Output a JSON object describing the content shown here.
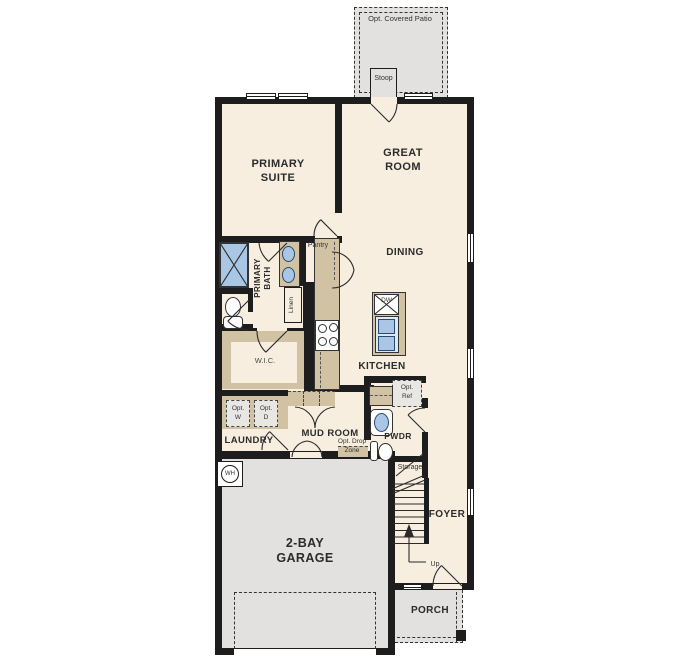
{
  "title": "First floor plan",
  "colors": {
    "floor_cream": "#f7eee0",
    "concrete_gray": "#e2e1df",
    "cabinet_tan": "#d1c2a4",
    "fixture_blue": "#a9c7e5",
    "wall_black": "#1d1d1d"
  },
  "labels": {
    "opt_covered_patio": "Opt. Covered Patio",
    "stoop": "Stoop",
    "primary_suite": "PRIMARY\nSUITE",
    "great_room": "GREAT\nROOM",
    "dining": "DINING",
    "kitchen": "KITCHEN",
    "primary_bath": "PRIMARY\nBATH",
    "pantry": "Pantry",
    "linen": "Linen",
    "wic": "W.I.C.",
    "laundry": "LAUNDRY",
    "mud_room": "MUD ROOM",
    "opt_w": "Opt.\nW",
    "opt_d": "Opt.\nD",
    "opt_ref": "Opt.\nRef",
    "opt_drop_zone": "Opt. Drop\nZone",
    "pwdr": "PWDR",
    "storage": "Storage",
    "foyer": "FOYER",
    "up": "Up",
    "porch": "PORCH",
    "garage": "2-BAY\nGARAGE",
    "wh": "WH",
    "dw": "DW"
  }
}
